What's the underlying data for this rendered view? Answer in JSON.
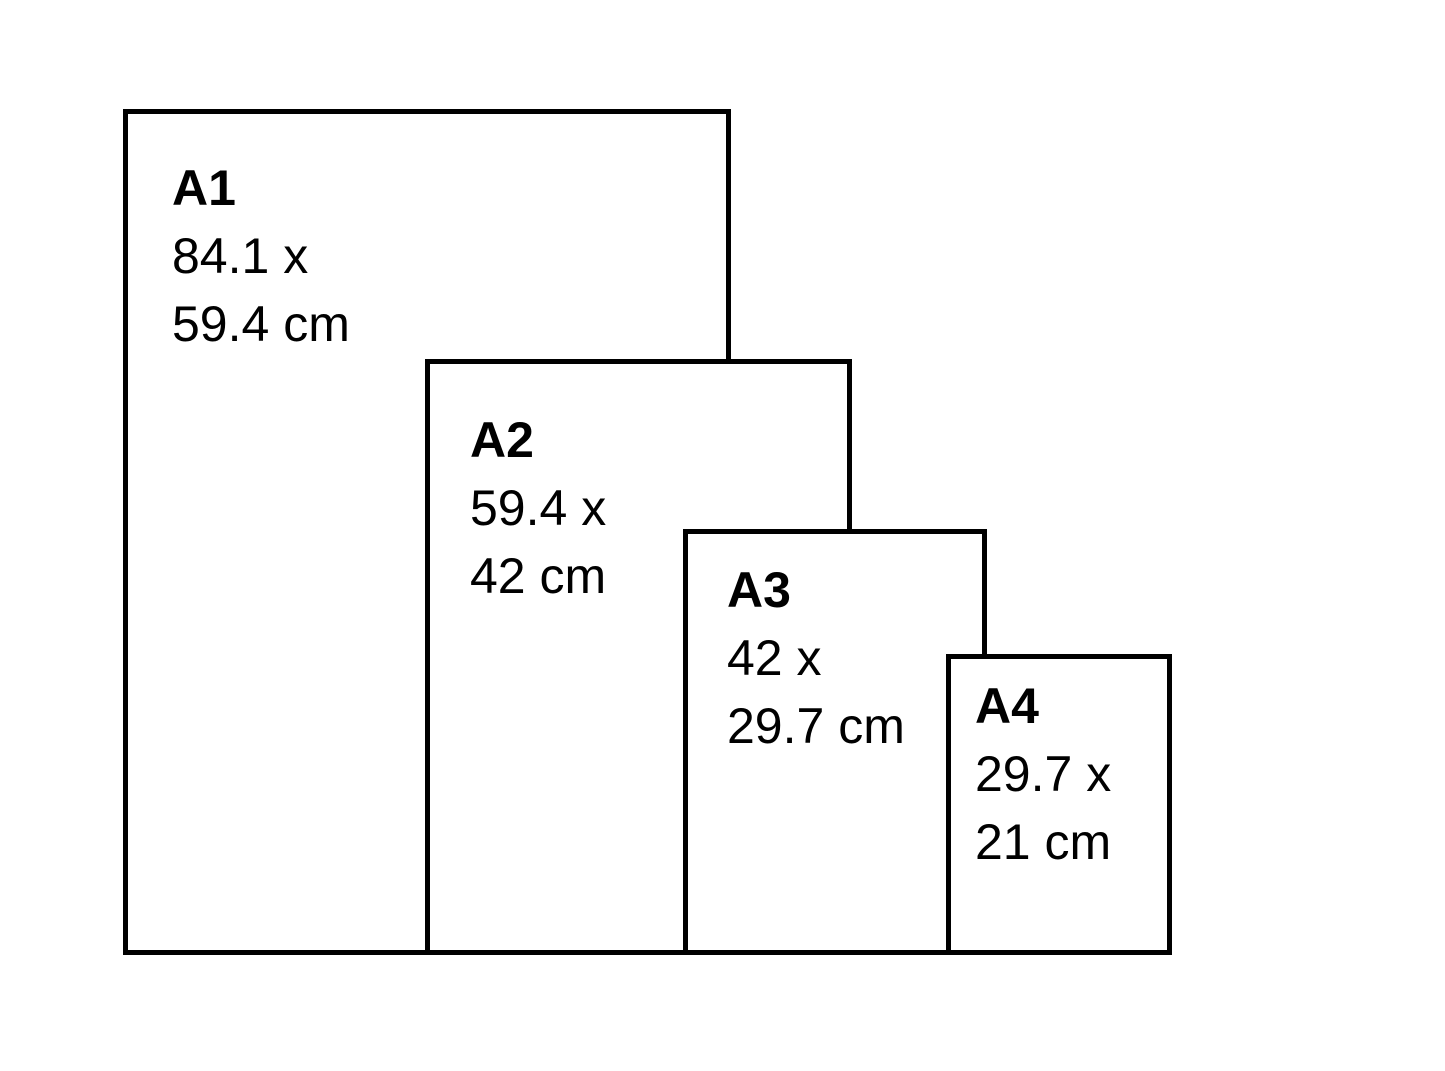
{
  "colors": {
    "background": "#ffffff",
    "paper_fill": "#ffffff",
    "border": "#000000",
    "text": "#000000"
  },
  "papers": [
    {
      "name": "A1",
      "dim_line1": "84.1 x",
      "dim_line2": "59.4 cm",
      "height_cm": 84.1,
      "width_cm": 59.4
    },
    {
      "name": "A2",
      "dim_line1": "59.4 x",
      "dim_line2": "42 cm",
      "height_cm": 59.4,
      "width_cm": 42
    },
    {
      "name": "A3",
      "dim_line1": "42 x",
      "dim_line2": "29.7 cm",
      "height_cm": 42,
      "width_cm": 29.7
    },
    {
      "name": "A4",
      "dim_line1": "29.7 x",
      "dim_line2": "21 cm",
      "height_cm": 29.7,
      "width_cm": 21
    }
  ]
}
